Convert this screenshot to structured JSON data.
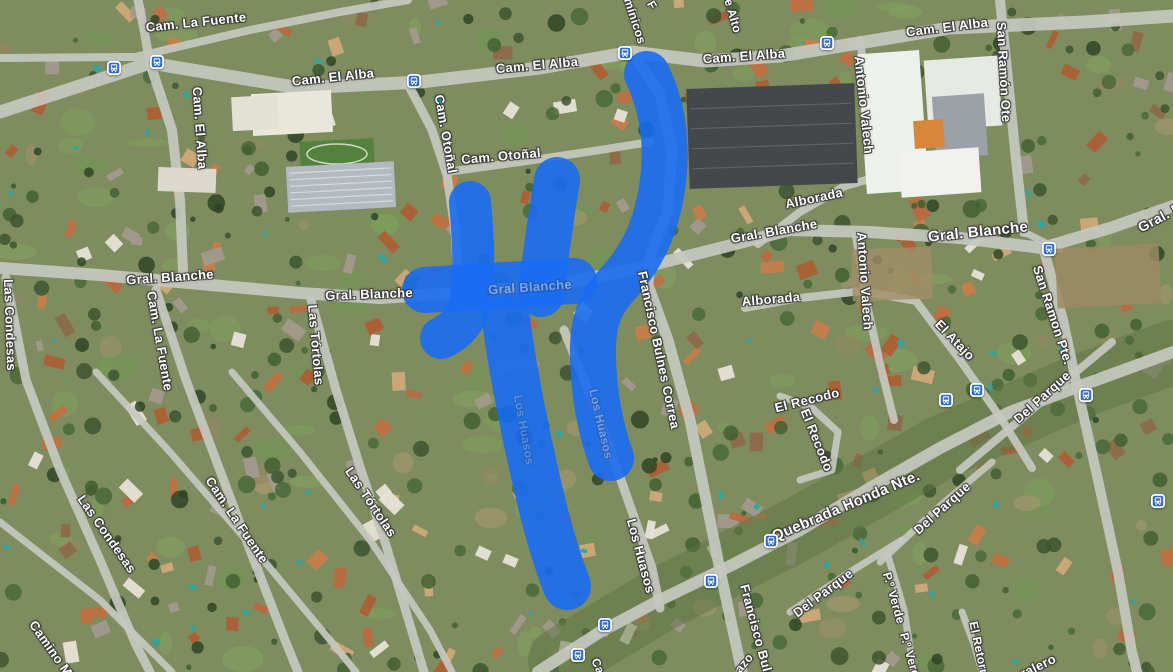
{
  "map": {
    "type": "satellite-with-labels",
    "annotation": {
      "description": "hand-drawn route highlight",
      "color": "#1a6bf2",
      "opacity": 0.9,
      "strokes": [
        {
          "w": 46,
          "d": "M 647 74 C 662 105 669 144 662 188 C 656 226 644 254 621 280 C 602 300 594 316 593 346 C 592 392 602 434 611 458"
        },
        {
          "w": 46,
          "d": "M 557 180 C 551 216 546 252 541 294"
        },
        {
          "w": 42,
          "d": "M 470 202 C 473 238 475 266 471 297 C 468 319 456 331 441 338"
        },
        {
          "w": 46,
          "d": "M 425 290 C 468 287 524 284 574 281"
        },
        {
          "w": 48,
          "d": "M 506 320 C 513 372 525 432 539 492 C 547 527 557 560 567 586"
        }
      ]
    },
    "street_labels": [
      {
        "text": "Cam. La Fuente",
        "x": 196,
        "y": 22,
        "rot": -6,
        "fs": 13
      },
      {
        "text": "Cam. El Alba",
        "x": 333,
        "y": 77,
        "rot": -6,
        "fs": 13
      },
      {
        "text": "Cam. El Alba",
        "x": 537,
        "y": 65,
        "rot": -5,
        "fs": 13
      },
      {
        "text": "Cam. El Alba",
        "x": 744,
        "y": 56,
        "rot": -4,
        "fs": 13
      },
      {
        "text": "Cam. El Alba",
        "x": 947,
        "y": 27,
        "rot": -7,
        "fs": 13
      },
      {
        "text": "Cam. El Alba",
        "x": 200,
        "y": 128,
        "rot": 86,
        "fs": 13
      },
      {
        "text": "mínicos",
        "x": 635,
        "y": 21,
        "rot": 72,
        "fs": 12
      },
      {
        "text": "F",
        "x": 652,
        "y": 5,
        "rot": 60,
        "fs": 12
      },
      {
        "text": "e Alto",
        "x": 733,
        "y": 16,
        "rot": 74,
        "fs": 12
      },
      {
        "text": "San Ramón Ote",
        "x": 1004,
        "y": 72,
        "rot": 87,
        "fs": 13
      },
      {
        "text": "Antonio Valech",
        "x": 864,
        "y": 105,
        "rot": 84,
        "fs": 13
      },
      {
        "text": "Cam. Otoñal",
        "x": 446,
        "y": 134,
        "rot": 80,
        "fs": 13
      },
      {
        "text": "Cam. Otoñal",
        "x": 501,
        "y": 156,
        "rot": -5,
        "fs": 13
      },
      {
        "text": "Gral. Blanche",
        "x": 170,
        "y": 277,
        "rot": -4,
        "fs": 13
      },
      {
        "text": "Gral. Blanche",
        "x": 369,
        "y": 294,
        "rot": -2,
        "fs": 13
      },
      {
        "text": "Gral. Blanche",
        "x": 774,
        "y": 231,
        "rot": -10,
        "fs": 13
      },
      {
        "text": "Gral. Blanche",
        "x": 978,
        "y": 232,
        "rot": -6,
        "fs": 15
      },
      {
        "text": "Gral. B",
        "x": 1160,
        "y": 217,
        "rot": -28,
        "fs": 14
      },
      {
        "text": "Alborada",
        "x": 814,
        "y": 198,
        "rot": -12,
        "fs": 13
      },
      {
        "text": "Alborada",
        "x": 771,
        "y": 299,
        "rot": -5,
        "fs": 13
      },
      {
        "text": "Antonio Valech",
        "x": 865,
        "y": 281,
        "rot": 86,
        "fs": 13
      },
      {
        "text": "San Ramon Pte.",
        "x": 1053,
        "y": 315,
        "rot": 72,
        "fs": 13
      },
      {
        "text": "El Atajo",
        "x": 955,
        "y": 340,
        "rot": 46,
        "fs": 13
      },
      {
        "text": "Francisco Bulnes Correa",
        "x": 659,
        "y": 350,
        "rot": 78,
        "fs": 13
      },
      {
        "text": "Las Condesas",
        "x": 10,
        "y": 325,
        "rot": 88,
        "fs": 13
      },
      {
        "text": "Cam. La Fuente",
        "x": 160,
        "y": 341,
        "rot": 80,
        "fs": 13
      },
      {
        "text": "Las Tórtolas",
        "x": 316,
        "y": 345,
        "rot": 85,
        "fs": 13
      },
      {
        "text": "Las Condesas",
        "x": 107,
        "y": 534,
        "rot": 55,
        "fs": 13
      },
      {
        "text": "Cam. La Fuente",
        "x": 237,
        "y": 520,
        "rot": 56,
        "fs": 13
      },
      {
        "text": "Las Tórtolas",
        "x": 371,
        "y": 502,
        "rot": 56,
        "fs": 13
      },
      {
        "text": "Camino Mi",
        "x": 52,
        "y": 650,
        "rot": 55,
        "fs": 13
      },
      {
        "text": "Los Huasos",
        "x": 641,
        "y": 556,
        "rot": 75,
        "fs": 13
      },
      {
        "text": "El Recodo",
        "x": 807,
        "y": 400,
        "rot": -14,
        "fs": 13
      },
      {
        "text": "El Recodo",
        "x": 817,
        "y": 440,
        "rot": 68,
        "fs": 13
      },
      {
        "text": "Quebrada Honda Nte.",
        "x": 846,
        "y": 506,
        "rot": -23,
        "fs": 15
      },
      {
        "text": "Del Parque",
        "x": 1042,
        "y": 397,
        "rot": -42,
        "fs": 13
      },
      {
        "text": "Del Parque",
        "x": 942,
        "y": 508,
        "rot": -42,
        "fs": 13
      },
      {
        "text": "Del Parque",
        "x": 823,
        "y": 593,
        "rot": -37,
        "fs": 13
      },
      {
        "text": "P.º Verde",
        "x": 894,
        "y": 598,
        "rot": 74,
        "fs": 12
      },
      {
        "text": "P.º Verd",
        "x": 910,
        "y": 655,
        "rot": 74,
        "fs": 12
      },
      {
        "text": "El Retorn",
        "x": 979,
        "y": 649,
        "rot": 78,
        "fs": 12
      },
      {
        "text": "Francisco Buln",
        "x": 757,
        "y": 632,
        "rot": 75,
        "fs": 13
      },
      {
        "text": "ralero",
        "x": 1038,
        "y": 666,
        "rot": -26,
        "fs": 13
      },
      {
        "text": "Ca",
        "x": 598,
        "y": 666,
        "rot": 66,
        "fs": 12
      },
      {
        "text": "azo",
        "x": 744,
        "y": 663,
        "rot": -50,
        "fs": 12
      },
      {
        "text": "Gral Blanche",
        "x": 530,
        "y": 287,
        "rot": -4,
        "fs": 13,
        "op": 0.38
      },
      {
        "text": "Los Huasos",
        "x": 601,
        "y": 424,
        "rot": 77,
        "fs": 12,
        "op": 0.3
      },
      {
        "text": "Los Huasos",
        "x": 524,
        "y": 430,
        "rot": 80,
        "fs": 12,
        "op": 0.22
      }
    ],
    "bus_stops": [
      {
        "x": 114,
        "y": 68
      },
      {
        "x": 157,
        "y": 62
      },
      {
        "x": 414,
        "y": 81
      },
      {
        "x": 625,
        "y": 53
      },
      {
        "x": 827,
        "y": 43
      },
      {
        "x": 1049,
        "y": 249
      },
      {
        "x": 946,
        "y": 400
      },
      {
        "x": 977,
        "y": 390
      },
      {
        "x": 1086,
        "y": 395
      },
      {
        "x": 1158,
        "y": 501
      },
      {
        "x": 771,
        "y": 541
      },
      {
        "x": 711,
        "y": 581
      },
      {
        "x": 605,
        "y": 625
      },
      {
        "x": 578,
        "y": 655
      }
    ],
    "roads": [
      {
        "w": 13,
        "pts": "0,112 150,63 300,88 420,82 540,68 632,52 705,61 780,56 950,28 1085,22 1173,16"
      },
      {
        "w": 8,
        "pts": "0,58 135,57 250,30 340,12 408,0"
      },
      {
        "w": 9,
        "pts": "138,0 144,30 150,63"
      },
      {
        "w": 10,
        "pts": "150,63 172,130 180,200 183,272"
      },
      {
        "w": 9,
        "pts": "408,84 432,130 447,175 455,230 458,282"
      },
      {
        "w": 8,
        "pts": "447,172 520,162 600,150 650,142"
      },
      {
        "w": 11,
        "pts": "633,54 660,95 672,150 668,210 650,255 648,285 668,340 690,420 706,500 720,570 735,640 742,672"
      },
      {
        "w": 12,
        "pts": "0,268 100,275 200,284 300,293 380,298 470,292 560,284 640,268 720,248 790,230 870,232 960,238 1042,248 1110,228 1173,206"
      },
      {
        "w": 10,
        "pts": "1000,0 1008,80 1016,160 1024,232"
      },
      {
        "w": 8,
        "pts": "860,40 869,110 876,172"
      },
      {
        "w": 8,
        "pts": "856,236 866,300 880,364 894,420"
      },
      {
        "w": 8,
        "pts": "758,244 800,212 845,186 895,172"
      },
      {
        "w": 8,
        "pts": "745,308 800,298 862,291 916,301 960,360 1002,420 1032,468"
      },
      {
        "w": 10,
        "pts": "1044,250 1063,320 1080,400 1098,480 1118,572 1132,652 1137,672"
      },
      {
        "w": 12,
        "pts": "538,672 600,632 660,600 730,566 800,530 870,488 940,448 1010,412 1080,386 1173,352"
      },
      {
        "w": 9,
        "pts": "564,330 600,420 628,500 652,568 660,608"
      },
      {
        "w": 9,
        "pts": "6,278 26,380 60,470 100,560 136,645 150,672"
      },
      {
        "w": 9,
        "pts": "156,290 186,380 216,460 250,550 285,640 298,672"
      },
      {
        "w": 9,
        "pts": "311,300 336,390 361,470 386,545 410,625 424,672"
      },
      {
        "w": 7,
        "pts": "0,522 100,600 172,672"
      },
      {
        "w": 7,
        "pts": "96,372 170,452 260,556 330,640 356,672"
      },
      {
        "w": 7,
        "pts": "232,372 300,452 370,540 430,630 452,672"
      },
      {
        "w": 8,
        "pts": "960,470 1020,420 1076,372 1112,342"
      },
      {
        "w": 7,
        "pts": "880,562 940,506 992,462"
      },
      {
        "w": 7,
        "pts": "790,612 850,572 902,540"
      },
      {
        "w": 7,
        "pts": "888,556 904,610 914,672"
      },
      {
        "w": 7,
        "pts": "962,612 974,644 982,672"
      },
      {
        "w": 7,
        "pts": "780,396 812,408 838,432 832,470 800,480"
      },
      {
        "w": 7,
        "pts": "1024,232 1060,250"
      }
    ],
    "greenways": [
      {
        "w": 64,
        "o": 0.5,
        "color": "#5e7344",
        "pts": "560,660 660,600 800,528 940,448 1080,386 1173,352"
      }
    ],
    "features": [
      {
        "type": "rect",
        "x": 688,
        "y": 86,
        "w": 168,
        "h": 100,
        "rot": -2,
        "fill": "#46474a",
        "stripes": 4,
        "sc": "#686a70"
      },
      {
        "type": "rect",
        "x": 862,
        "y": 52,
        "w": 62,
        "h": 140,
        "rot": -4,
        "fill": "#eef0ec"
      },
      {
        "type": "rect",
        "x": 926,
        "y": 58,
        "w": 74,
        "h": 70,
        "rot": -4,
        "fill": "#e7e9e4"
      },
      {
        "type": "rect",
        "x": 934,
        "y": 95,
        "w": 52,
        "h": 62,
        "rot": -4,
        "fill": "#9ba1a6"
      },
      {
        "type": "rect",
        "x": 914,
        "y": 120,
        "w": 30,
        "h": 28,
        "rot": -4,
        "fill": "#d8863a"
      },
      {
        "type": "rect",
        "x": 900,
        "y": 150,
        "w": 80,
        "h": 45,
        "rot": -4,
        "fill": "#f1f2ee"
      },
      {
        "type": "rect",
        "x": 1056,
        "y": 246,
        "w": 104,
        "h": 60,
        "rot": -3,
        "fill": "#9c8a63",
        "o": 0.85
      },
      {
        "type": "rect",
        "x": 852,
        "y": 248,
        "w": 80,
        "h": 52,
        "rot": -2,
        "fill": "#a08e66",
        "o": 0.8
      },
      {
        "type": "rect",
        "x": 252,
        "y": 92,
        "w": 80,
        "h": 42,
        "rot": -3,
        "fill": "#e9e6da"
      },
      {
        "type": "rect",
        "x": 232,
        "y": 96,
        "w": 46,
        "h": 34,
        "rot": -3,
        "fill": "#e3e0d4"
      },
      {
        "type": "rect",
        "x": 300,
        "y": 140,
        "w": 74,
        "h": 28,
        "rot": -3,
        "fill": "#55813e"
      },
      {
        "type": "ellipse",
        "cx": 337,
        "cy": 154,
        "rx": 30,
        "ry": 10,
        "stroke": "#cfd8c2",
        "fill": "none"
      },
      {
        "type": "rect",
        "x": 287,
        "y": 164,
        "w": 108,
        "h": 46,
        "rot": -3,
        "fill": "#b3b9bf",
        "stripes": 6,
        "sc": "#dfe3e7"
      },
      {
        "type": "rect",
        "x": 158,
        "y": 168,
        "w": 58,
        "h": 24,
        "rot": 2,
        "fill": "#dcd8cd"
      }
    ],
    "palette": {
      "ground": "#7e8c5f",
      "road": "#c6c8c0",
      "tree": [
        "#3c5530",
        "#2f4526",
        "#49683a",
        "#426034"
      ],
      "lawn": [
        "#7ca45a",
        "#86a95e",
        "#6f9a50"
      ],
      "dirt": [
        "#a3916b",
        "#ac9a70",
        "#97855f"
      ],
      "roof": [
        "#bf7040",
        "#c67d4a",
        "#ad5f33",
        "#b96a3e",
        "#cfa978",
        "#e7e2d6",
        "#a29a8d",
        "#8d6a48"
      ],
      "pool": "#2aa6a2",
      "bus_icon": "#2e6bd7",
      "label_text": "#ffffff"
    },
    "texture_counts": {
      "lawns": 90,
      "dirt": 42,
      "houses": 240,
      "trees": 330,
      "pools": 48
    }
  }
}
